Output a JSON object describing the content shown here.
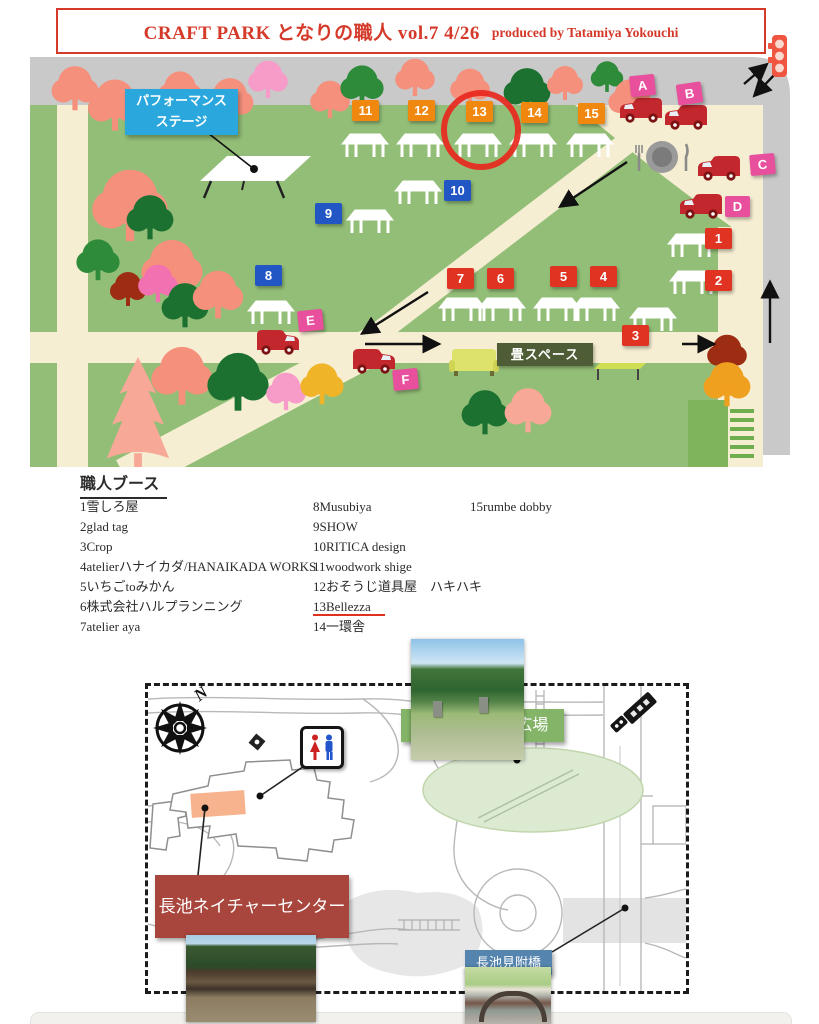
{
  "header": {
    "title": "CRAFT PARK となりの職人 vol.7 4/26",
    "credit": "produced by Tatamiya Yokouchi"
  },
  "park_map": {
    "stage_label_line1": "パフォーマンス",
    "stage_label_line2": "ステージ",
    "tatami_label": "畳スペース",
    "highlighted_booth": "13",
    "booths": {
      "orange": [
        "11",
        "12",
        "13",
        "14",
        "15"
      ],
      "blue": [
        "8",
        "9",
        "10"
      ],
      "red": [
        "1",
        "2",
        "3",
        "4",
        "5",
        "6",
        "7"
      ],
      "pink": [
        "A",
        "B",
        "C",
        "D",
        "E",
        "F"
      ]
    }
  },
  "vendor_list": {
    "title": "職人ブース",
    "col1": [
      "1雪しろ屋",
      "2glad tag",
      "3Crop",
      "4atelierハナイカダ/HANAIKADA WORKS",
      "5いちごtoみかん",
      "6株式会社ハルプランニング",
      "7atelier aya"
    ],
    "col2": [
      "8Musubiya",
      "9SHOW",
      "10RITICA design",
      "11woodwork shige",
      "12おそうじ道具屋　ハキハキ",
      "13Bellezza",
      "14一環舎"
    ],
    "col3": [
      "15rumbe dobby"
    ],
    "highlighted_item": "13Bellezza"
  },
  "location_map": {
    "compass": "N",
    "plaza_label": "CRAFT PARK広場",
    "nature_center_label": "長池ネイチャーセンター",
    "bridge_label": "長池見附橋"
  },
  "colors": {
    "header-red": "#d4392a",
    "underline-red": "#e0301e",
    "booth-orange": "#f0870f",
    "booth-blue": "#2356c5",
    "booth-red": "#e03322",
    "booth-pink": "#e8509d",
    "stage-blue": "#2aa7dc",
    "tatami-green": "#4e5d35",
    "plaza-green": "#83b467",
    "nature-red": "#a8453c",
    "bridge-blue": "#5584ae",
    "circle-red": "#e8281e",
    "map-green": "#93be77",
    "road-gray": "#c9c9c9",
    "path-cream": "#f6eed3",
    "van-red": "#c1272d"
  }
}
